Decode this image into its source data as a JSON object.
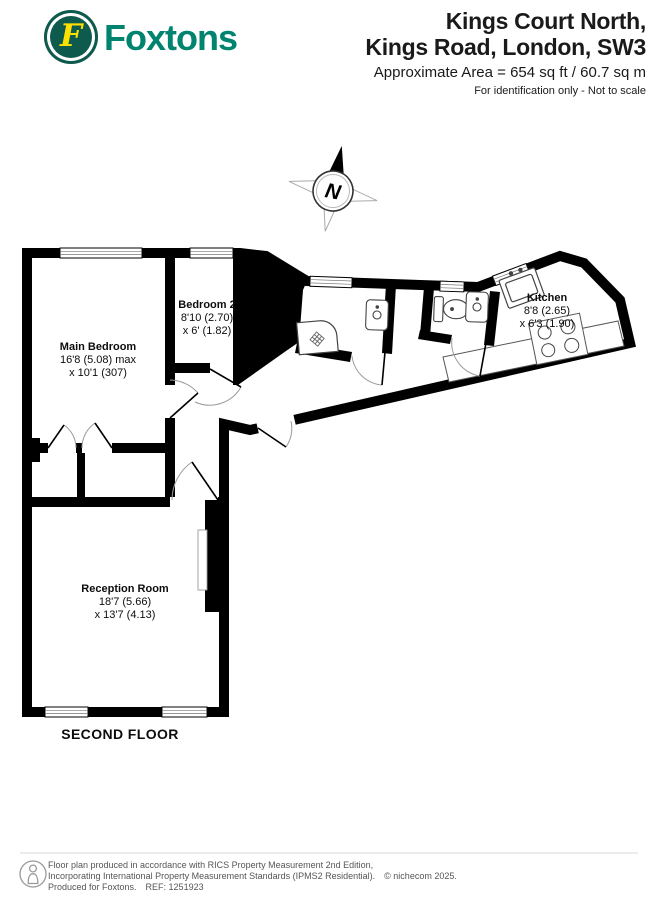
{
  "header": {
    "brand": "Foxtons",
    "logo_letter": "F",
    "title_line1": "Kings Court North,",
    "title_line2": "Kings Road, London, SW3",
    "area": "Approximate Area = 654 sq ft / 60.7 sq m",
    "note": "For identification only - Not to scale"
  },
  "compass": {
    "north_label": "N"
  },
  "plan": {
    "floor_label": "SECOND FLOOR",
    "rooms": [
      {
        "name": "Main Bedroom",
        "dim_line1": "16'8 (5.08) max",
        "dim_line2": "x 10'1 (307)"
      },
      {
        "name": "Bedroom 2",
        "dim_line1": "8'10 (2.70)",
        "dim_line2": "x 6' (1.82)"
      },
      {
        "name": "Kitchen",
        "dim_line1": "8'8 (2.65)",
        "dim_line2": "x 6'3 (1.90)"
      },
      {
        "name": "Reception Room",
        "dim_line1": "18'7 (5.66)",
        "dim_line2": "x 13'7 (4.13)"
      }
    ]
  },
  "footer": {
    "line1": "Floor plan produced in accordance with RICS Property Measurement 2nd Edition,",
    "line2": "Incorporating International Property Measurement Standards (IPMS2 Residential).",
    "copyright": "© nichecom 2025.",
    "line3": "Produced for Foxtons.",
    "ref": "REF: 1251923"
  },
  "colors": {
    "foxtons_green": "#0e5a4c",
    "foxtons_teal": "#00836f",
    "foxtons_yellow": "#ffe100",
    "wall_black": "#000000"
  }
}
